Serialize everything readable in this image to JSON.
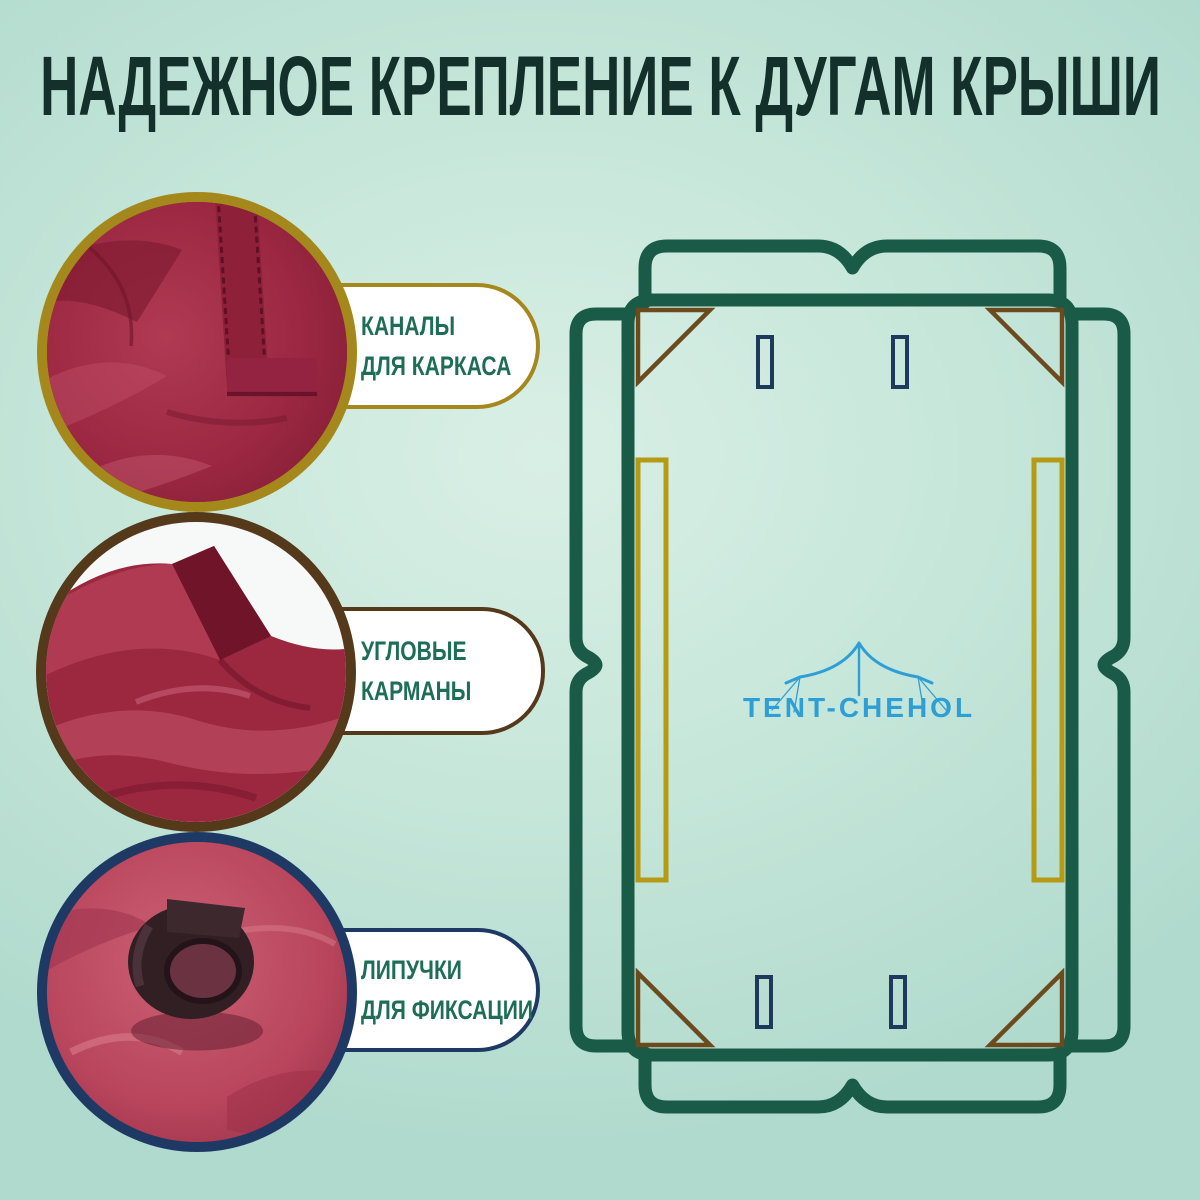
{
  "title": "НАДЕЖНОЕ КРЕПЛЕНИЕ К ДУГАМ КРЫШИ",
  "features": [
    {
      "label_line1": "КАНАЛЫ",
      "label_line2": "ДЛЯ КАРКАСА",
      "accent_color": "#a5881c",
      "photo": "бордовая ткань с прошитым каналом для каркаса"
    },
    {
      "label_line1": "УГЛОВЫЕ",
      "label_line2": "КАРМАНЫ",
      "accent_color": "#54391b",
      "photo": "угловой карман из бордовой ткани"
    },
    {
      "label_line1": "ЛИПУЧКИ",
      "label_line2": "ДЛЯ ФИКСАЦИИ",
      "accent_color": "#1e3a64",
      "photo": "ремешок-липучка на красной ткани"
    }
  ],
  "schematic": {
    "brand": "TENT-CHEHOL",
    "brand_color": "#2d9fd6",
    "outline_color": "#1a5b48",
    "corner_color": "#6b4a1d",
    "channel_color": "#b59a15",
    "slot_color": "#1d3a5c"
  },
  "colors": {
    "background_light": "#d9efe6",
    "background_dark": "#b0dacd",
    "title_color": "#13312a",
    "label_color": "#1d6e55",
    "bubble_fill": "#ffffff"
  }
}
